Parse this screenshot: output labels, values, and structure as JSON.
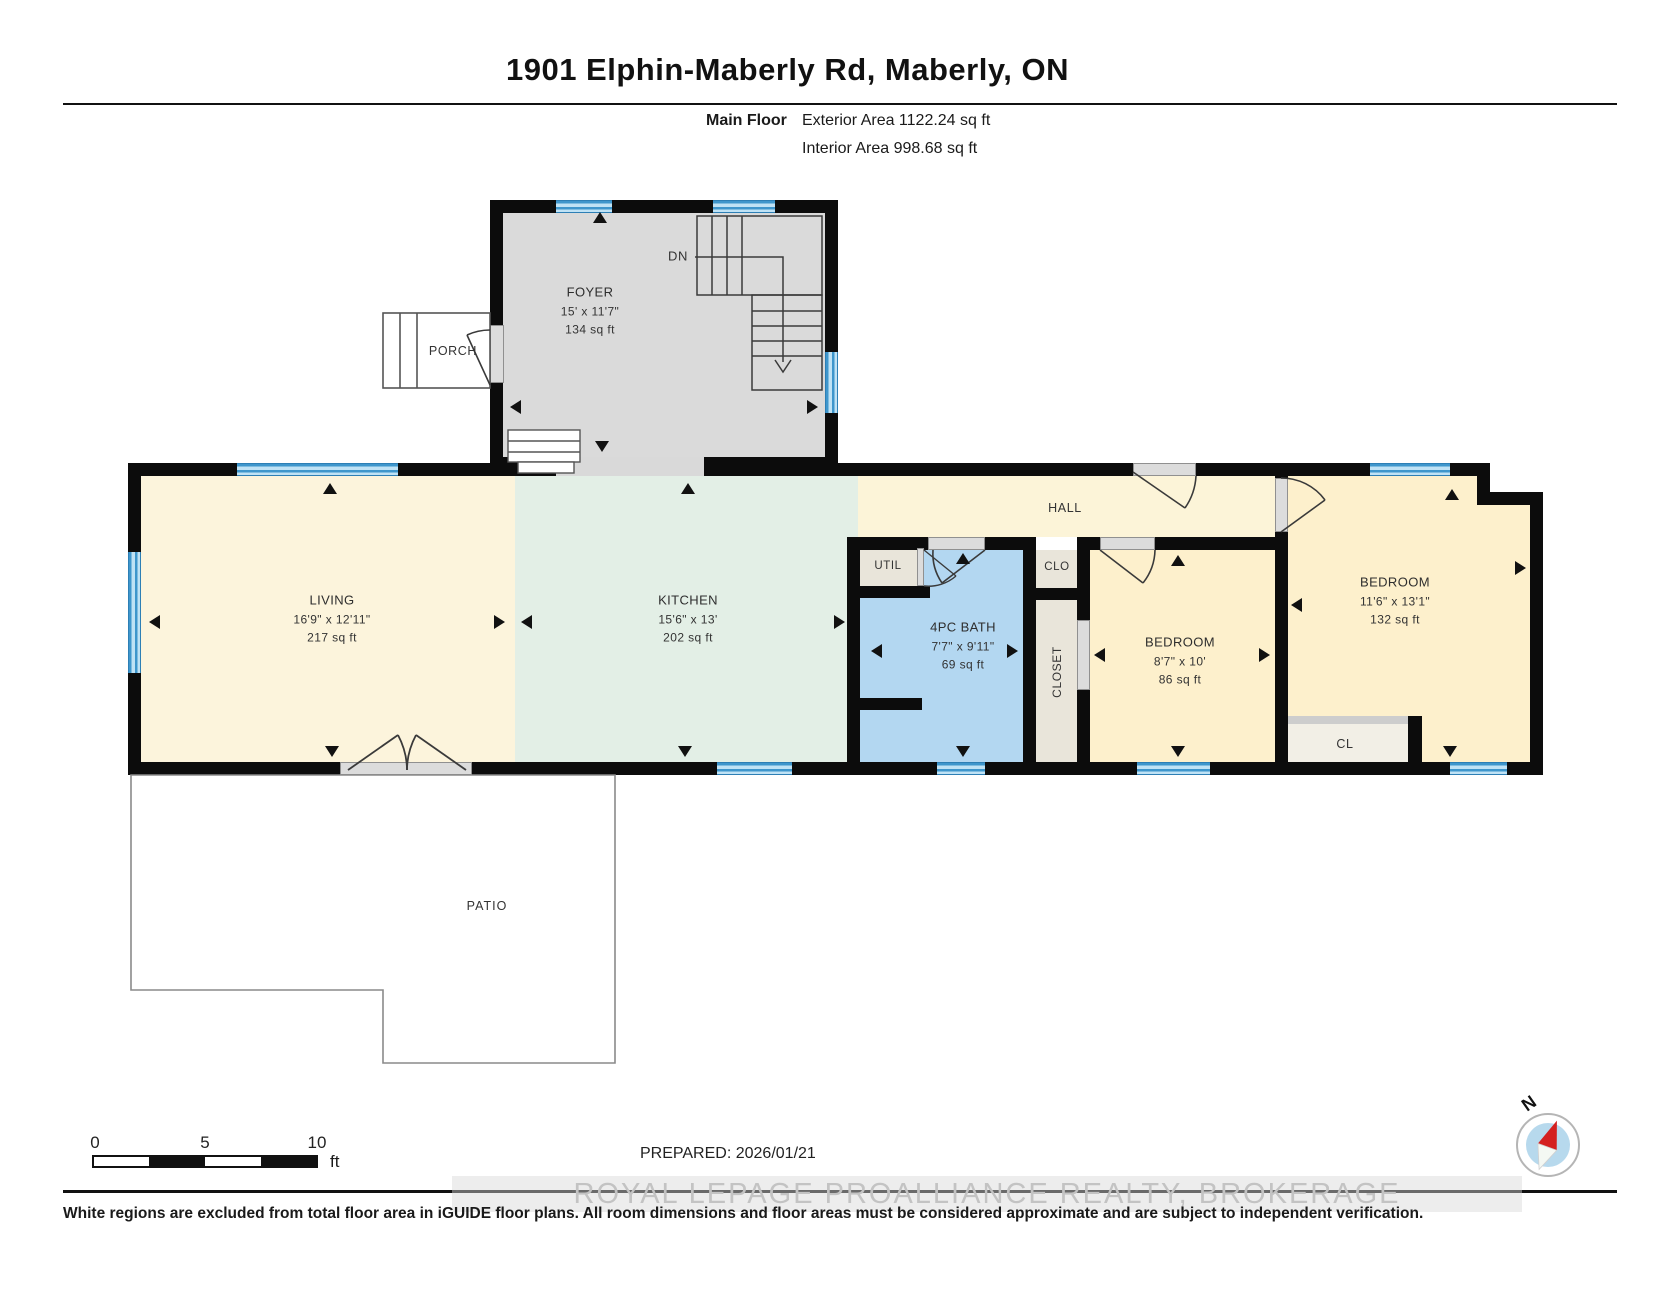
{
  "title": "1901 Elphin-Maberly Rd, Maberly, ON",
  "floor_info": {
    "label": "Main Floor",
    "exterior": "Exterior Area 1122.24 sq ft",
    "interior": "Interior Area 998.68 sq ft"
  },
  "rooms": {
    "foyer": {
      "name": "FOYER",
      "dims": "15' x 11'7\"",
      "area": "134 sq ft"
    },
    "living": {
      "name": "LIVING",
      "dims": "16'9\" x 12'11\"",
      "area": "217 sq ft"
    },
    "kitchen": {
      "name": "KITCHEN",
      "dims": "15'6\" x 13'",
      "area": "202 sq ft"
    },
    "bath": {
      "name": "4PC BATH",
      "dims": "7'7\" x 9'11\"",
      "area": "69 sq ft"
    },
    "bedroom_small": {
      "name": "BEDROOM",
      "dims": "8'7\" x 10'",
      "area": "86 sq ft"
    },
    "bedroom_large": {
      "name": "BEDROOM",
      "dims": "11'6\" x 13'1\"",
      "area": "132 sq ft"
    },
    "hall": "HALL",
    "util": "UTIL",
    "clo": "CLO",
    "closet": "CLOSET",
    "cl": "CL",
    "porch": "PORCH",
    "patio": "PATIO",
    "stairs": "DN"
  },
  "scale_bar": {
    "tick0": "0",
    "tick5": "5",
    "tick10": "10",
    "unit": "ft"
  },
  "compass": {
    "north_label": "N"
  },
  "footer": {
    "prepared": "PREPARED: 2026/01/21",
    "watermark": "ROYAL LEPAGE PROALLIANCE REALTY, BROKERAGE",
    "disclaimer": "White regions are excluded from total floor area in iGUIDE floor plans. All room dimensions and floor areas must be considered approximate and are subject to independent verification."
  },
  "colors": {
    "wall": "#0c0c0c",
    "window_blue": "#3e96cc",
    "bath_fill": "#b3d7f1",
    "bedroom_fill": "#fdf0cc",
    "living_fill": "#fcf4dc",
    "kitchen_fill": "#e3efe6",
    "foyer_fill": "#dadada",
    "closet_fill": "#e9e5da",
    "compass_needle": "#d42020"
  }
}
